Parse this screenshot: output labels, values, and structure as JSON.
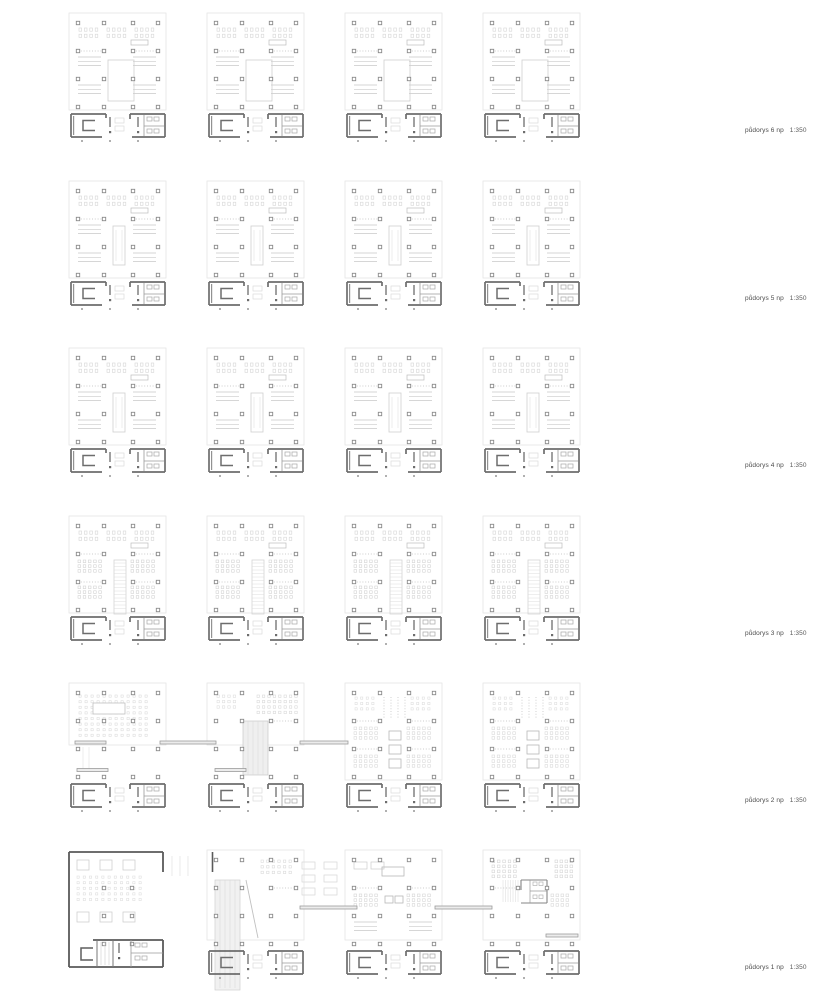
{
  "sheet": {
    "type": "architectural-floor-plan-sheet",
    "plans_per_row": 4
  },
  "colors": {
    "background": "#ffffff",
    "faint": "#e3e3e3",
    "light": "#d6d6d6",
    "mid": "#bdbdbd",
    "dot": "#bcbcbc",
    "column": "#8a8a8a",
    "core": "#6d6d6d",
    "wall": "#5a5a5a",
    "bar_fill": "#ececec",
    "bar_stroke": "#9c9c9c",
    "ramp_fill": "#f1f1f1",
    "ramp_line": "#dcdcdc",
    "label_text": "#4a4a4a"
  },
  "rows": [
    {
      "floor": "6",
      "label": "půdorys 6 np",
      "scale": "1:350",
      "plans": [
        "atrium",
        "atrium",
        "atrium",
        "atrium"
      ]
    },
    {
      "floor": "5",
      "label": "půdorys 5 np",
      "scale": "1:350",
      "plans": [
        "shaft",
        "shaft",
        "shaft",
        "shaft"
      ]
    },
    {
      "floor": "4",
      "label": "půdorys 4 np",
      "scale": "1:350",
      "plans": [
        "shaft",
        "shaft",
        "shaft",
        "shaft"
      ]
    },
    {
      "floor": "3",
      "label": "půdorys 3 np",
      "scale": "1:350",
      "plans": [
        "classroom",
        "classroom",
        "classroom",
        "classroom"
      ]
    },
    {
      "floor": "2",
      "label": "půdorys 2 np",
      "scale": "1:350",
      "plans": [
        "open-left",
        "open-ramp",
        "full-meeting",
        "full-meeting"
      ]
    },
    {
      "floor": "1",
      "label": "půdorys 1 np",
      "scale": "1:350",
      "plans": [
        "hall",
        "ground-ramp",
        "ground-open",
        "ground-wc"
      ]
    }
  ]
}
